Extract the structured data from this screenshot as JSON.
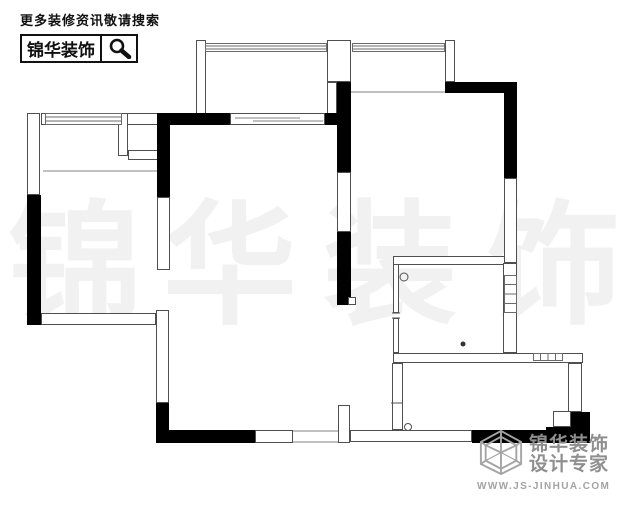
{
  "header": {
    "tagline": "更多装修资讯敬请搜索",
    "brand": "锦华装饰"
  },
  "footer": {
    "brand_line1": "锦华装饰",
    "brand_line2": "设计专家",
    "url": "WWW.JS-JINHUA.COM"
  },
  "watermark": {
    "text": "锦华装饰",
    "color": "#f1f1f1",
    "font_size": 134,
    "baseline_y": 312,
    "chars": [
      {
        "c": "锦",
        "x": 8
      },
      {
        "c": "华",
        "x": 163
      },
      {
        "c": "装",
        "x": 323
      },
      {
        "c": "饰",
        "x": 487
      }
    ]
  },
  "plan": {
    "colors": {
      "wall_fill": "#000000",
      "line": "#4f4f4f",
      "gray": "#9c9c9c",
      "window_line": "#6a6a6a",
      "white": "#ffffff"
    },
    "thin_walls": [
      [
        196,
        40,
        10,
        74
      ],
      [
        327,
        40,
        24,
        42
      ],
      [
        327,
        82,
        10,
        32
      ],
      [
        445,
        40,
        10,
        42
      ],
      [
        27,
        113,
        13,
        82
      ],
      [
        41,
        113,
        117,
        12
      ],
      [
        118,
        113,
        10,
        43
      ],
      [
        128,
        150,
        30,
        10
      ],
      [
        157,
        197,
        13,
        73
      ],
      [
        337,
        172,
        14,
        60
      ],
      [
        504,
        178,
        13,
        85
      ],
      [
        156,
        310,
        13,
        93
      ],
      [
        41,
        313,
        115,
        12
      ],
      [
        255,
        430,
        38,
        13
      ],
      [
        338,
        405,
        12,
        38
      ],
      [
        350,
        430,
        122,
        12
      ],
      [
        392,
        363,
        11,
        67
      ],
      [
        393,
        264,
        6,
        49
      ],
      [
        393,
        318,
        6,
        35
      ],
      [
        393,
        256,
        112,
        9
      ],
      [
        503,
        263,
        14,
        90
      ],
      [
        393,
        353,
        190,
        10
      ],
      [
        568,
        363,
        14,
        49
      ],
      [
        230,
        113,
        95,
        12
      ]
    ],
    "black_walls": [
      [
        158,
        113,
        72,
        12
      ],
      [
        325,
        113,
        26,
        12
      ],
      [
        337,
        82,
        14,
        90
      ],
      [
        337,
        232,
        14,
        73
      ],
      [
        157,
        113,
        13,
        84
      ],
      [
        27,
        195,
        14,
        130
      ],
      [
        445,
        82,
        72,
        11
      ],
      [
        504,
        93,
        13,
        85
      ],
      [
        156,
        403,
        13,
        40
      ],
      [
        156,
        430,
        99,
        13
      ],
      [
        472,
        430,
        118,
        13
      ],
      [
        570,
        412,
        20,
        31
      ],
      [
        546,
        427,
        25,
        16
      ]
    ],
    "white_boxes": [
      [
        348,
        297,
        8,
        8
      ],
      [
        553,
        411,
        18,
        16
      ]
    ],
    "windows_h": [
      [
        205,
        43,
        122,
        9
      ],
      [
        352,
        43,
        93,
        9
      ],
      [
        45,
        113,
        77,
        12
      ]
    ],
    "window_hatch": [
      [
        504,
        275,
        13,
        38
      ],
      [
        533,
        353,
        30,
        8
      ]
    ],
    "gray_lines": [
      [
        43,
        171,
        158,
        171
      ],
      [
        350,
        92,
        445,
        92
      ],
      [
        293,
        431,
        338,
        431
      ],
      [
        293,
        442,
        338,
        442
      ],
      [
        235,
        118,
        300,
        118
      ],
      [
        253,
        121,
        323,
        121
      ]
    ],
    "dark_ticks": [
      [
        392,
        313,
        400,
        313
      ],
      [
        392,
        318,
        400,
        318
      ],
      [
        391,
        403,
        403,
        403
      ]
    ],
    "circles_stroke": [
      [
        404,
        277,
        4
      ],
      [
        408,
        427,
        3.5
      ]
    ],
    "circles_fill": [
      [
        463,
        344,
        2.5
      ]
    ]
  }
}
